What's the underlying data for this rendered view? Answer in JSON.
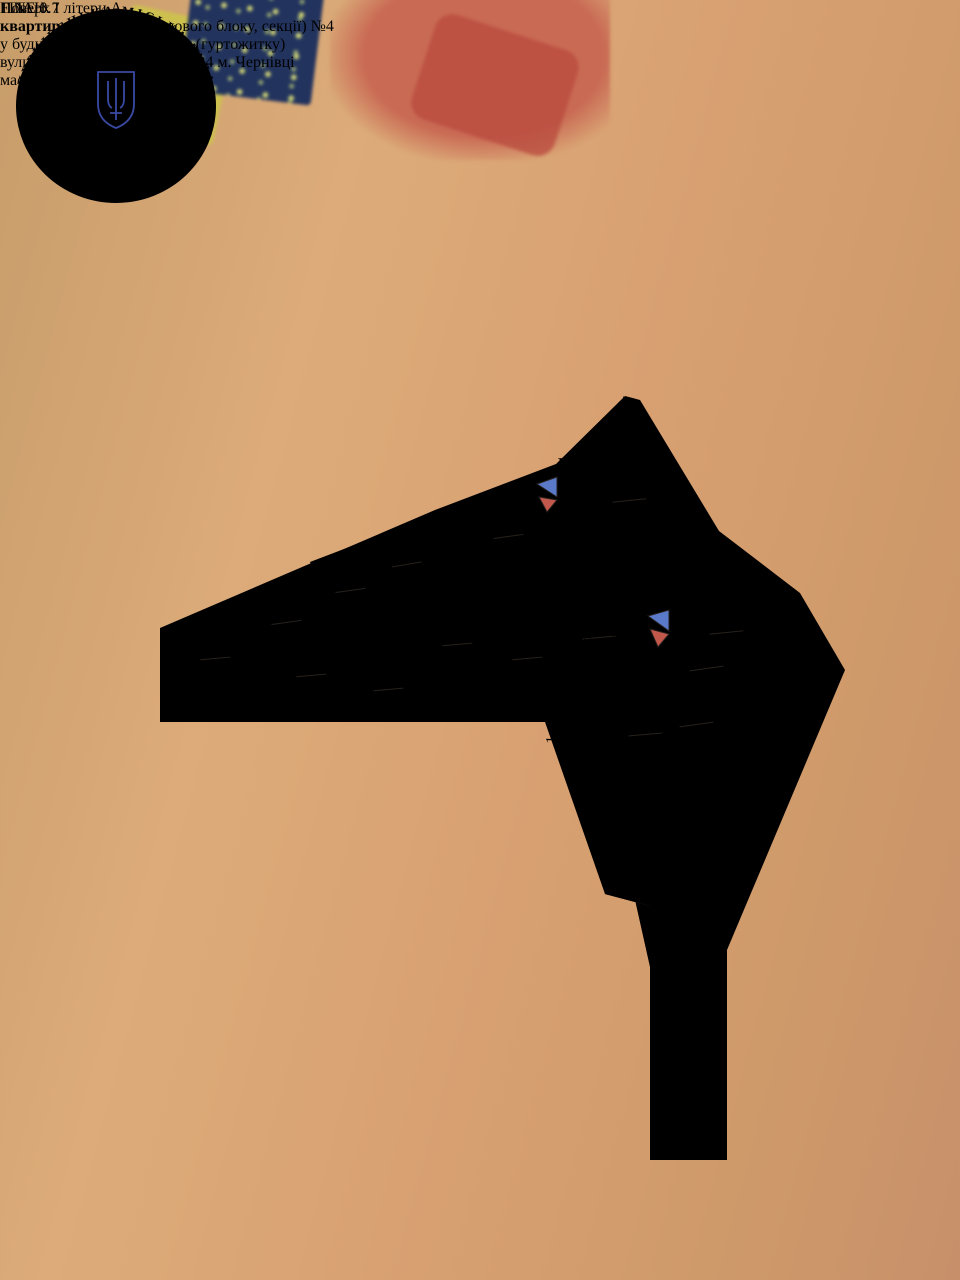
{
  "scene": {
    "banknote_value": "1",
    "pen_label": "FINE 0.7"
  },
  "document": {
    "title": "ПЛАН",
    "subtitle_bold": "квартири",
    "subtitle_rest": " (кімнати, житлового блоку, секції) ",
    "subtitle_number": "№4",
    "line3": "у будинку квартирного типу (гуртожитку)",
    "line4": "вулиця  Б. Хмельницького № 24 м. Чернівці",
    "line5": "масштаб 1:100",
    "floor_line": "Поверх І літери А"
  },
  "plan": {
    "height_note": "Н=2.60",
    "colors": {
      "wall": "#d59b82",
      "highlight_room_outline": "#4d6fd0",
      "room_id": "#8a3026",
      "vent_blue": "#5b79c9",
      "vent_red": "#c2574b"
    },
    "rooms": [
      {
        "id": "4-1",
        "area": "6.70",
        "x": 527,
        "y": 655,
        "r": -5
      },
      {
        "id": "4-2",
        "area": "6.30",
        "x": 457,
        "y": 641,
        "r": -5
      },
      {
        "id": "4-3",
        "area": "1.00",
        "x": 388,
        "y": 686,
        "r": -5
      },
      {
        "id": "4-4",
        "area": "4.70",
        "x": 311,
        "y": 672,
        "r": -5
      },
      {
        "id": "4-5",
        "area": "2.70",
        "x": 215,
        "y": 655,
        "r": -5
      },
      {
        "id": "4-6",
        "area": "2.80",
        "x": 286,
        "y": 619,
        "r": -8
      },
      {
        "id": "4-7",
        "area": "4.90",
        "x": 350,
        "y": 587,
        "r": -8,
        "highlighted": true
      },
      {
        "id": "4-8",
        "area": "2.10",
        "x": 406,
        "y": 561,
        "r": -10
      },
      {
        "id": "4-9",
        "area": "8.50",
        "x": 508,
        "y": 533,
        "r": -8
      },
      {
        "id": "4-10",
        "area": "14.00",
        "x": 629,
        "y": 497,
        "r": -6
      },
      {
        "id": "4-11",
        "area": "10.70",
        "x": 726,
        "y": 629,
        "r": -6
      },
      {
        "id": "4-12",
        "area": "3.10",
        "x": 599,
        "y": 634,
        "r": -5
      },
      {
        "id": "4-13",
        "area": "0.90",
        "x": 645,
        "y": 731,
        "r": -5
      },
      {
        "id": "4-14",
        "area": "0.70",
        "x": 706,
        "y": 665,
        "r": -8
      },
      {
        "id": "4-15",
        "area": "3.20",
        "x": 696,
        "y": 721,
        "r": -8
      }
    ],
    "dims": [
      {
        "v": "1.34",
        "x": 214,
        "y": 646,
        "r": -4
      },
      {
        "v": "1.56",
        "x": 196,
        "y": 671,
        "r": -92
      },
      {
        "v": "1.44",
        "x": 215,
        "y": 691,
        "r": -4
      },
      {
        "v": "1.20",
        "x": 264,
        "y": 678,
        "r": -92
      },
      {
        "v": "0.80",
        "x": 262,
        "y": 637,
        "r": -92
      },
      {
        "v": "2.30",
        "x": 298,
        "y": 648,
        "r": -8
      },
      {
        "v": "1.79",
        "x": 277,
        "y": 607,
        "r": -30
      },
      {
        "v": "2.91",
        "x": 311,
        "y": 693,
        "r": -6
      },
      {
        "v": "2.11",
        "x": 317,
        "y": 621,
        "r": -70
      },
      {
        "v": "2.07",
        "x": 341,
        "y": 571,
        "r": -32
      },
      {
        "v": "2.34",
        "x": 325,
        "y": 604,
        "r": -64
      },
      {
        "v": "2.24",
        "x": 380,
        "y": 596,
        "r": -64
      },
      {
        "v": "1.04",
        "x": 390,
        "y": 546,
        "r": -22
      },
      {
        "v": "1.73",
        "x": 400,
        "y": 582,
        "r": -68
      },
      {
        "v": "1.38",
        "x": 417,
        "y": 591,
        "r": -20
      },
      {
        "v": "1.48",
        "x": 434,
        "y": 607,
        "r": -20
      },
      {
        "v": "0.68",
        "x": 424,
        "y": 621,
        "r": -78
      },
      {
        "v": "1.79",
        "x": 369,
        "y": 633,
        "r": -32
      },
      {
        "v": "1.78",
        "x": 385,
        "y": 648,
        "r": -34
      },
      {
        "v": "1.54",
        "x": 379,
        "y": 667,
        "r": -34
      },
      {
        "v": "2.01",
        "x": 425,
        "y": 670,
        "r": -88
      },
      {
        "v": "0.93",
        "x": 435,
        "y": 698,
        "r": -6
      },
      {
        "v": "1.21",
        "x": 471,
        "y": 702,
        "r": -7
      },
      {
        "v": "2.08",
        "x": 488,
        "y": 673,
        "r": -88
      },
      {
        "v": "1.88",
        "x": 504,
        "y": 675,
        "r": -88
      },
      {
        "v": "1.10",
        "x": 517,
        "y": 641,
        "r": -32
      },
      {
        "v": "1.68",
        "x": 524,
        "y": 697,
        "r": -4
      },
      {
        "v": "3.51",
        "x": 471,
        "y": 567,
        "r": -68
      },
      {
        "v": "1.79",
        "x": 463,
        "y": 612,
        "r": -68
      },
      {
        "v": "1.63",
        "x": 510,
        "y": 505,
        "r": -27
      },
      {
        "v": "3.32",
        "x": 562,
        "y": 535,
        "r": -64
      },
      {
        "v": "3.35",
        "x": 585,
        "y": 529,
        "r": -64
      },
      {
        "v": "4.13",
        "x": 662,
        "y": 491,
        "r": -64
      },
      {
        "v": "3.15",
        "x": 674,
        "y": 566,
        "r": -64
      },
      {
        "v": "1.27",
        "x": 638,
        "y": 592,
        "r": -62
      },
      {
        "v": "2.40",
        "x": 548,
        "y": 590,
        "r": -10
      },
      {
        "v": "3.57",
        "x": 754,
        "y": 598,
        "r": -56
      },
      {
        "v": "3.13",
        "x": 754,
        "y": 676,
        "r": -56
      },
      {
        "v": "1.45",
        "x": 579,
        "y": 615,
        "r": -16
      },
      {
        "v": "1.17",
        "x": 578,
        "y": 648,
        "r": -4
      },
      {
        "v": "2.58",
        "x": 619,
        "y": 645,
        "r": -74
      },
      {
        "v": "1.31",
        "x": 634,
        "y": 675,
        "r": -56
      },
      {
        "v": "1.42",
        "x": 577,
        "y": 661,
        "r": -4
      },
      {
        "v": "3.00",
        "x": 592,
        "y": 702,
        "r": -88
      },
      {
        "v": "1.01",
        "x": 612,
        "y": 743,
        "r": -88
      },
      {
        "v": "1.45",
        "x": 557,
        "y": 730,
        "r": -88
      },
      {
        "v": "1.17",
        "x": 574,
        "y": 752,
        "r": -4
      },
      {
        "v": "1.80",
        "x": 655,
        "y": 753,
        "r": -4
      }
    ]
  },
  "stamp": {
    "ring_outer": "ЧЕРНІВЕЦЬКА  МІСЬКА  РАДА",
    "ring_inner": "КОМУНАЛЬНЕ БЮРО ТЕХНІЧНОЇ ІНВЕНТАРИЗАЦІЇ ★ МІСЬКЕ",
    "country": "УКРАЇНА",
    "code": "30935793",
    "ink_color": "#3949a3"
  }
}
